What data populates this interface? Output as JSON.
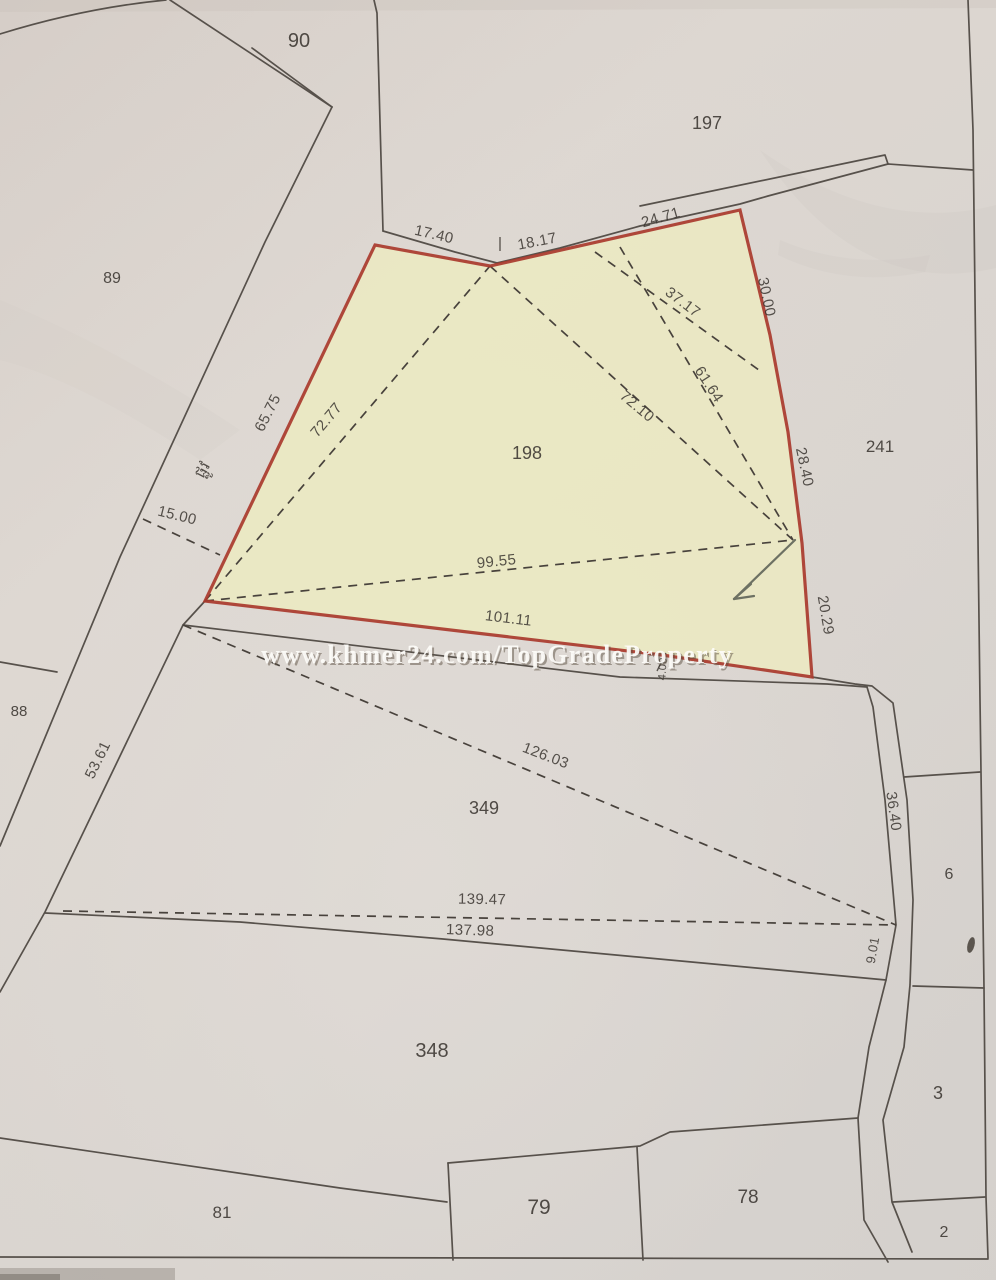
{
  "watermark": {
    "text": "www.khmer24.com/TopGradeProperty"
  },
  "road_label": "ផ្លូវ",
  "colors": {
    "paper": "#dbd4ce",
    "highlight_fill": "#ece9c2",
    "highlight_outline": "#a93a2d",
    "boundary_line": "#57514b",
    "label_ink": "#3b3631",
    "watermark": "#fdfcf9"
  },
  "parcels": {
    "90": "90",
    "197": "197",
    "89": "89",
    "241": "241",
    "198": "198",
    "88": "88",
    "349": "349",
    "348": "348",
    "81": "81",
    "79": "79",
    "78": "78",
    "6": "6",
    "3": "3",
    "2": "2"
  },
  "measurements": {
    "m17_40": "17.40",
    "m18_17": "18.17",
    "m24_71": "24.71",
    "m30_00": "30.00",
    "m37_17": "37.17",
    "m61_64": "61.64",
    "m72_10": "72.10",
    "m72_77": "72.77",
    "m65_75": "65.75",
    "m15_00": "15.00",
    "m28_40": "28.40",
    "m99_55": "99.55",
    "m101_11": "101.11",
    "m20_29": "20.29",
    "m4_00": "4.00",
    "m53_61": "53.61",
    "m126_03": "126.03",
    "m36_40": "36.40",
    "m9_01": "9.01",
    "m139_47": "139.47",
    "m137_98": "137.98"
  }
}
